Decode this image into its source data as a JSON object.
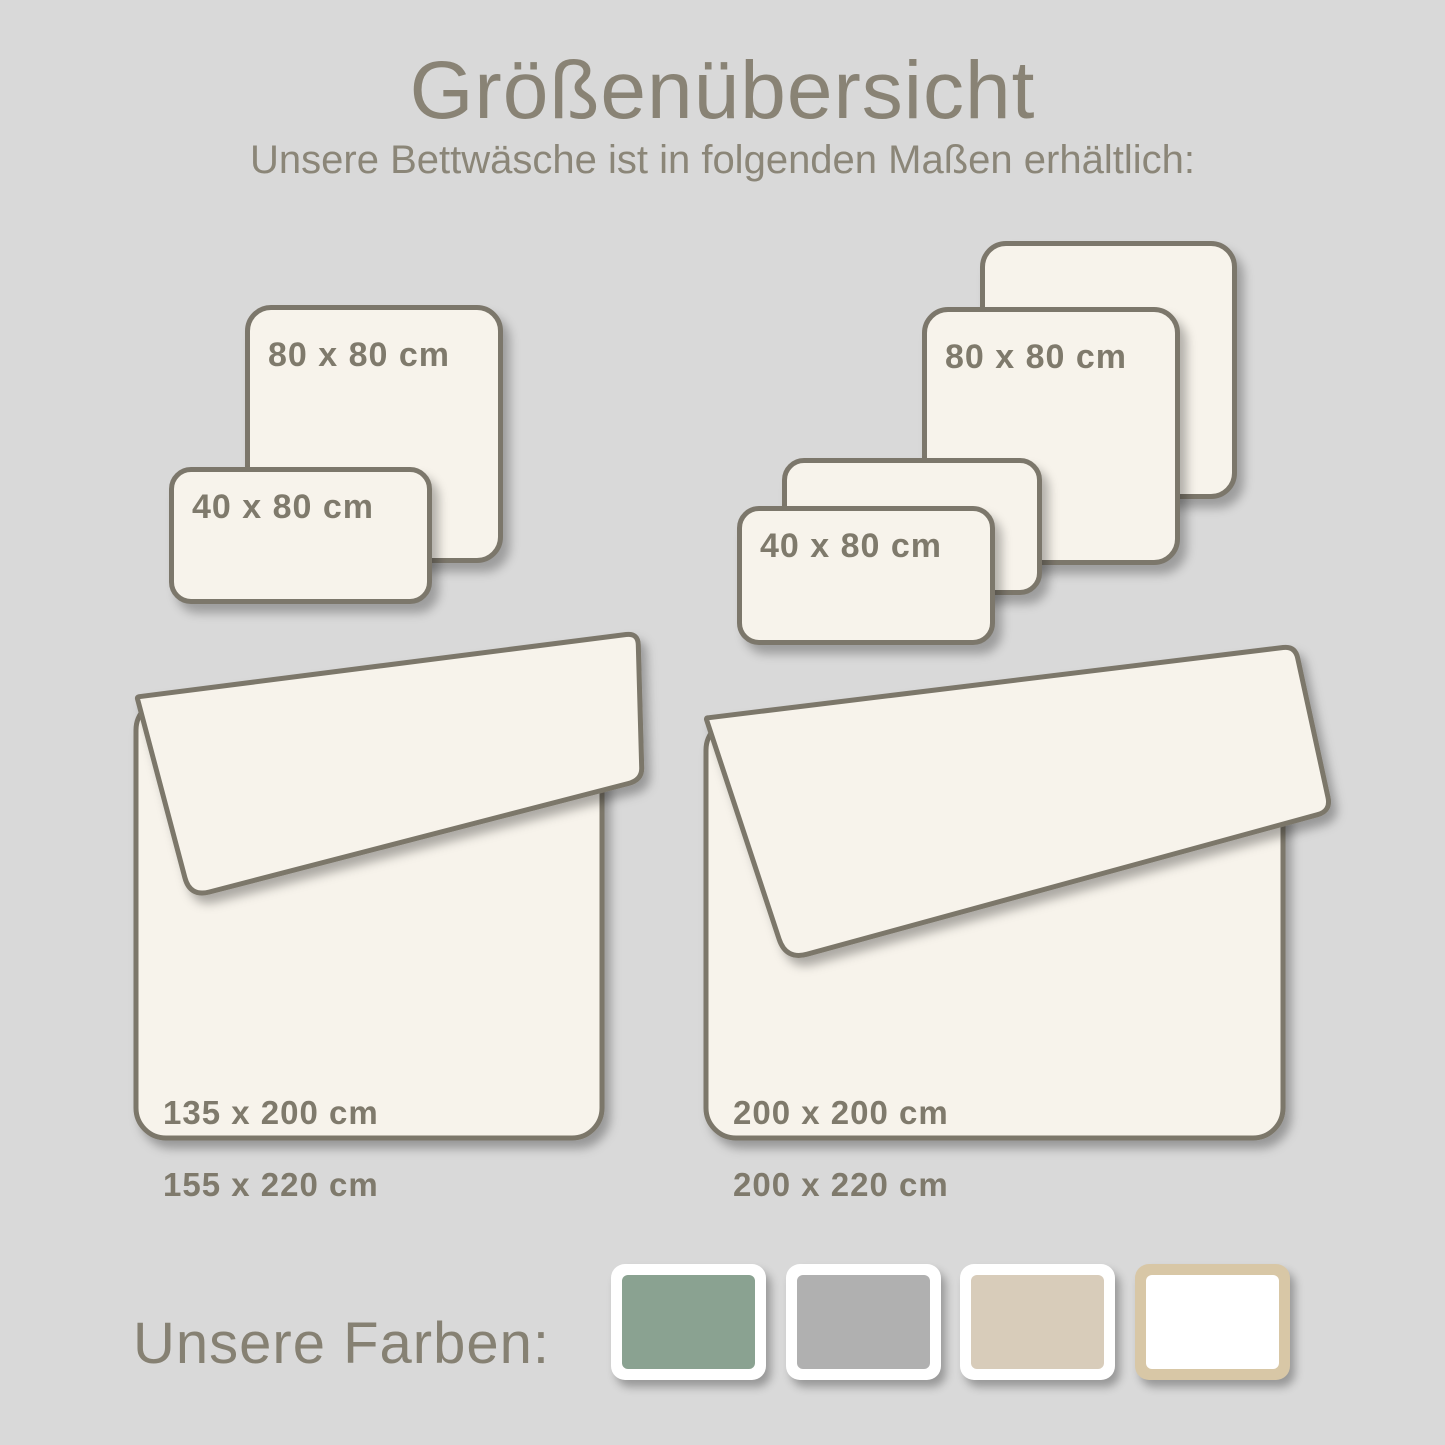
{
  "header": {
    "title": "Größenübersicht",
    "subtitle": "Unsere Bettwäsche ist in folgenden Maßen erhältlich:"
  },
  "pillows": {
    "left_group": {
      "square_label": "80 x 80 cm",
      "rect_label": "40 x 80 cm"
    },
    "right_group": {
      "square_label": "80 x 80 cm",
      "rect_label": "40 x 80 cm"
    }
  },
  "duvets": {
    "left": {
      "size_line1": "135 x 200 cm",
      "size_line2": "155 x 220 cm"
    },
    "right": {
      "size_line1": "200 x 200 cm",
      "size_line2": "200 x 220 cm"
    }
  },
  "colors_section": {
    "label": "Unsere Farben:",
    "swatches": [
      {
        "name": "green",
        "hex": "#8aa291"
      },
      {
        "name": "grey",
        "hex": "#b0b0b0"
      },
      {
        "name": "beige",
        "hex": "#d8ccba"
      },
      {
        "name": "white",
        "hex": "#ffffff",
        "frame": "#d8c7a6"
      }
    ]
  },
  "palette": {
    "background": "#d9d9d9",
    "shape_fill": "#f7f3eb",
    "outline": "#7c776b",
    "text": "#8b8678"
  }
}
